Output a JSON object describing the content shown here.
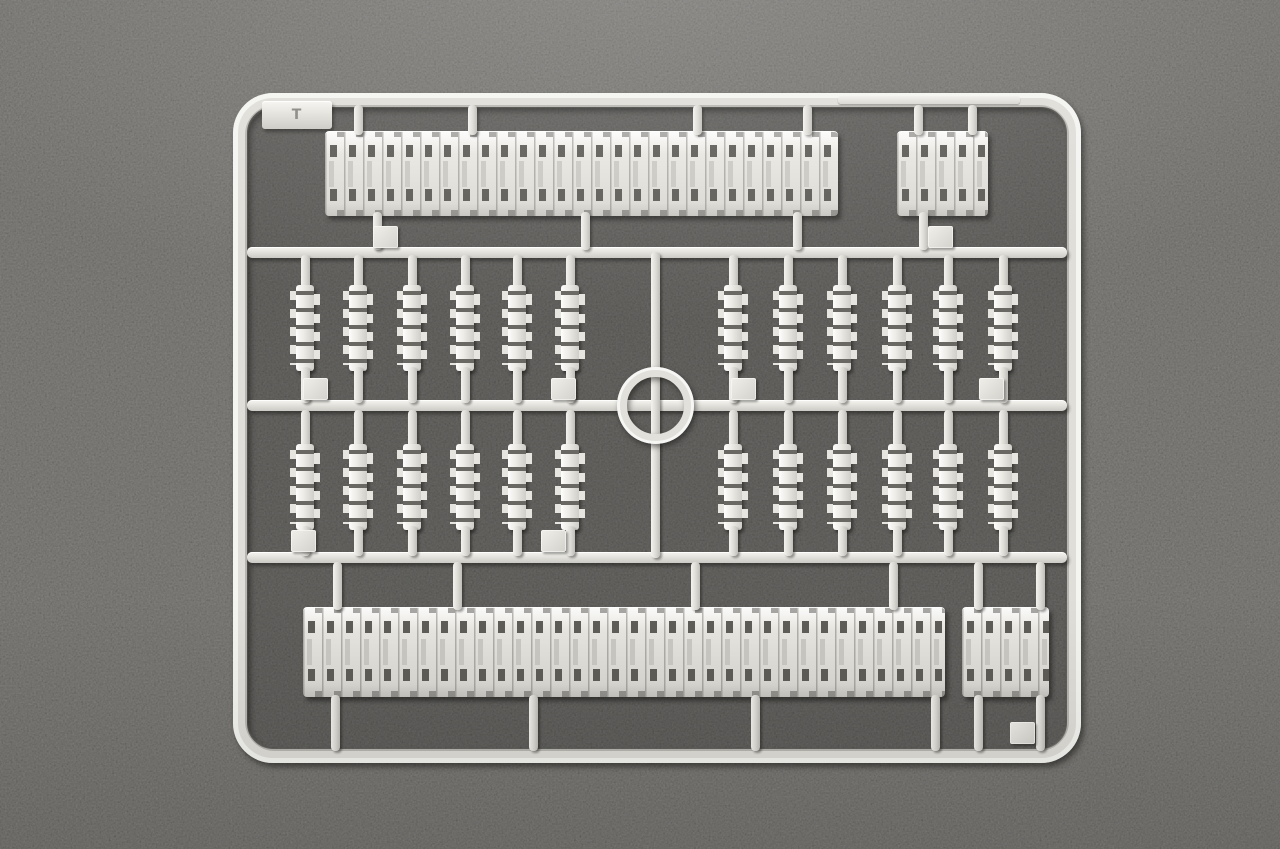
{
  "scene": {
    "subject": "injection-molded plastic sprue of tank track links photographed on grey fabric",
    "colors": {
      "plastic": "#e6e4de",
      "plastic_highlight": "#f6f5f1",
      "plastic_shadow": "#bfbdb7",
      "slot_dark": "#5f5d58",
      "fabric_background": "#55534f",
      "inner_shadow": "#3c3b39"
    },
    "corner_mark": "T"
  },
  "sprue": {
    "long_track_strips": 2,
    "short_track_segments": 2,
    "top_strip_link_count": 27,
    "bottom_strip_link_count": 34,
    "short_segment_link_count": 4,
    "loose_link_columns_left": 6,
    "loose_link_columns_right": 6,
    "loose_link_rows": 2,
    "loose_links_total": 24,
    "center_rings": 1,
    "crossbars": 3,
    "numbered_tabs": 9
  }
}
